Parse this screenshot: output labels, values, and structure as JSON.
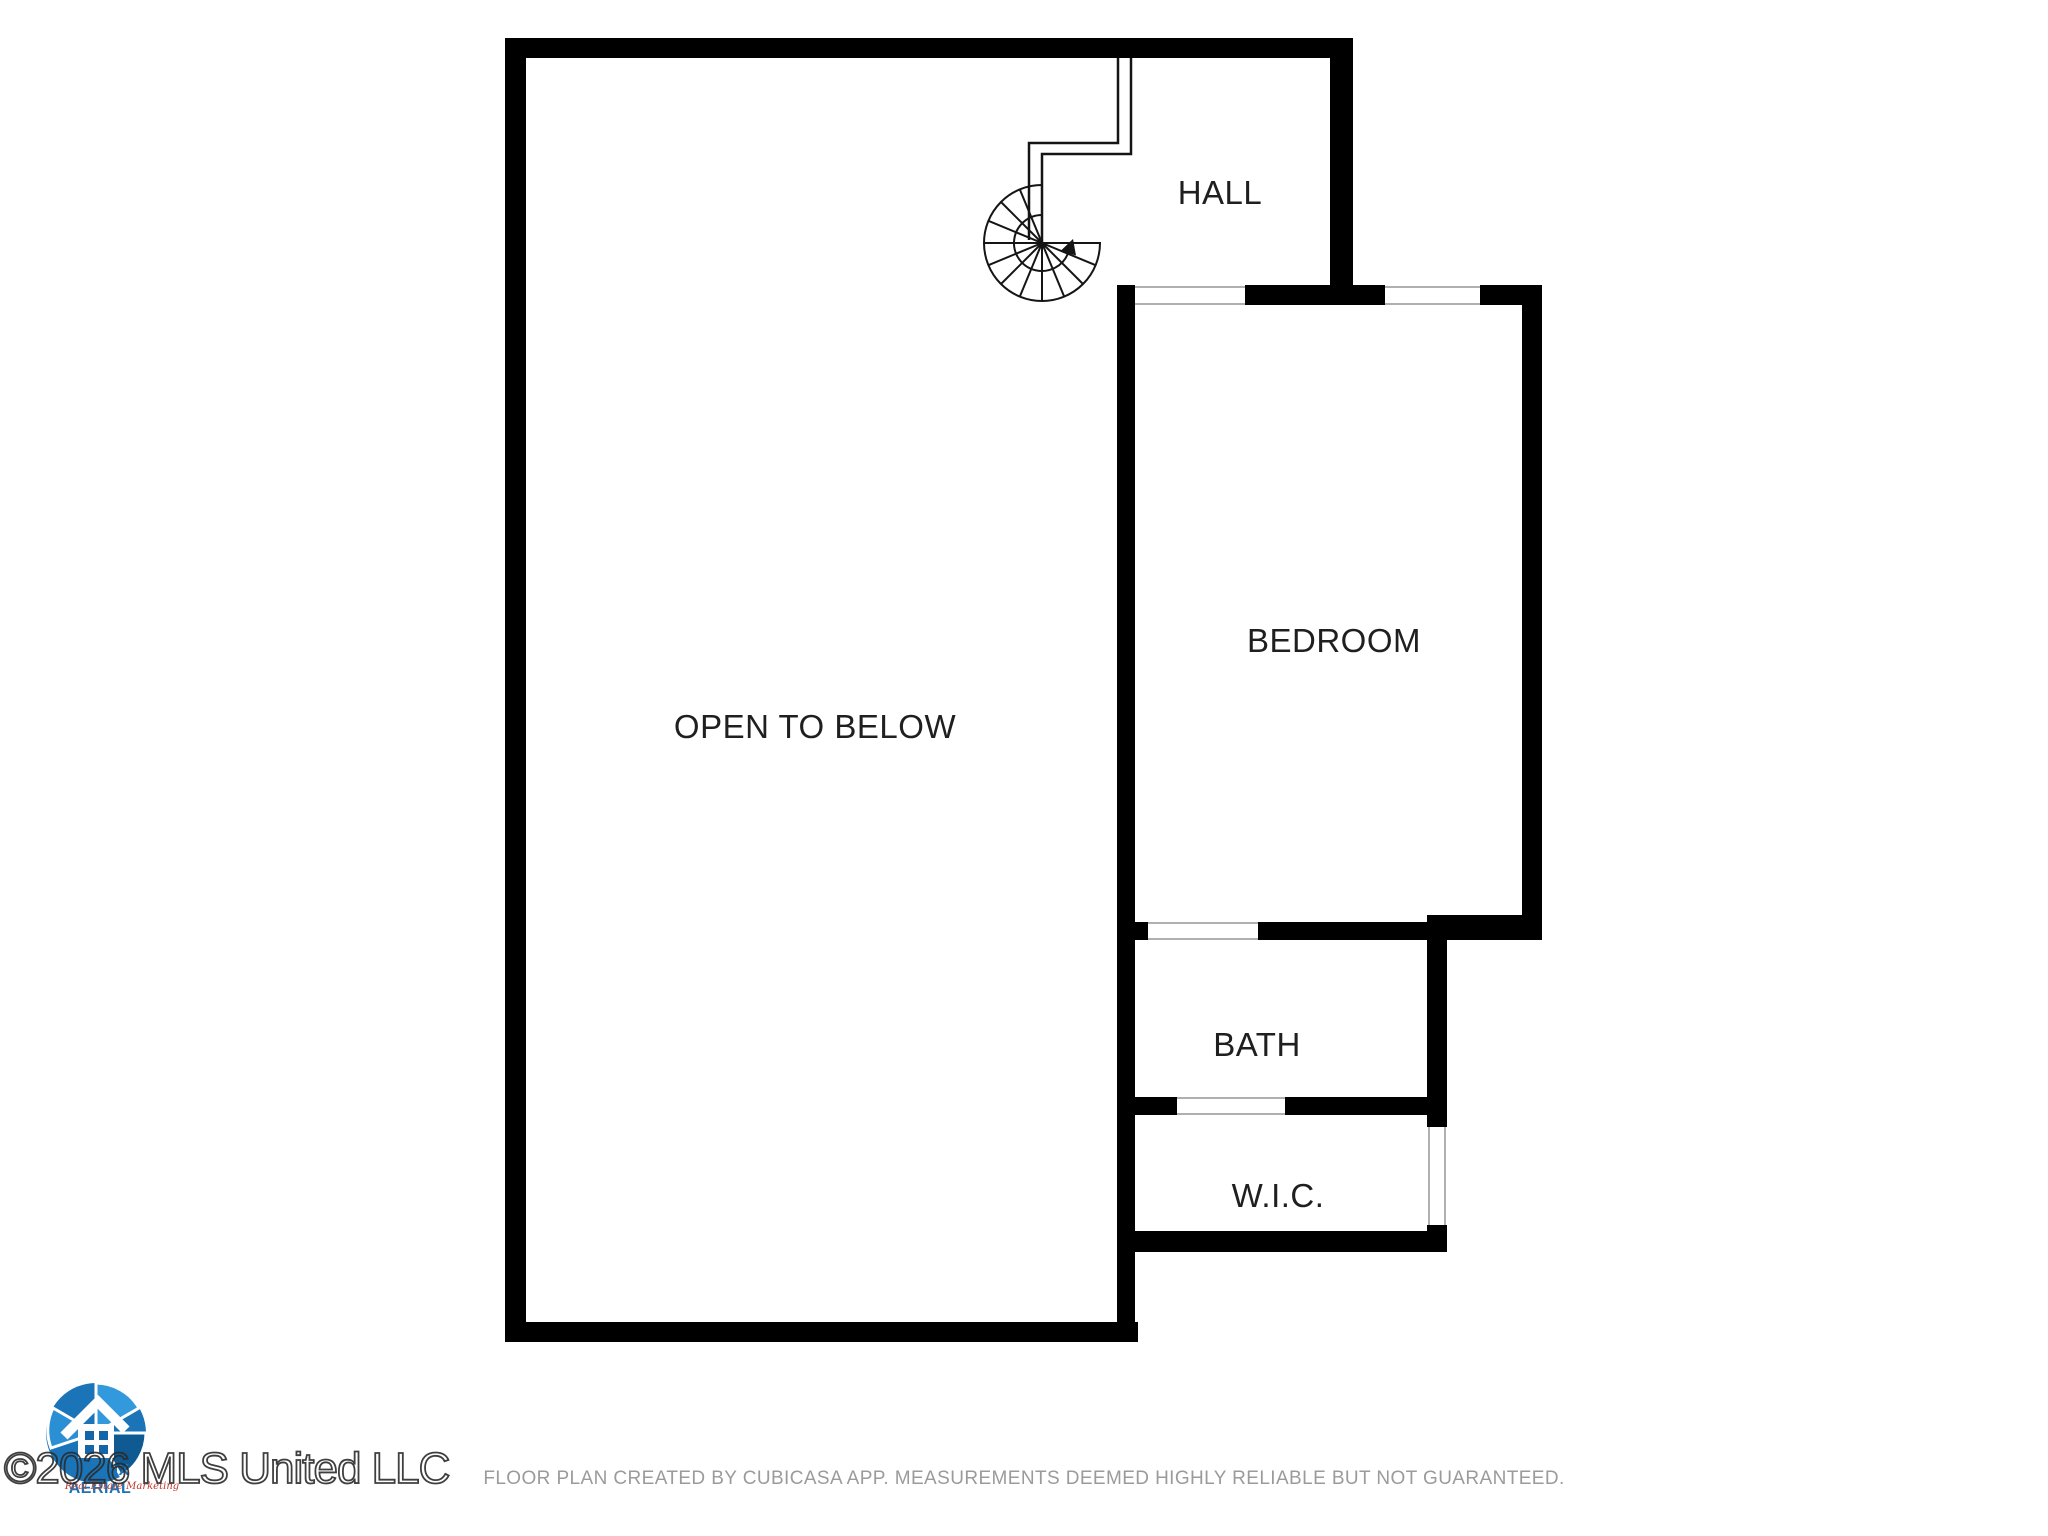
{
  "rooms": {
    "hall": {
      "label": "HALL"
    },
    "bedroom": {
      "label": "BEDROOM"
    },
    "open_to_below": {
      "label": "OPEN TO BELOW"
    },
    "bath": {
      "label": "BATH"
    },
    "wic": {
      "label": "W.I.C."
    }
  },
  "icons": {
    "staircase": "spiral-staircase-icon",
    "logo": "camera-shutter-house-logo"
  },
  "watermark": {
    "text": "©2026 MLS United LLC"
  },
  "logo": {
    "wordmark": "GEAUX AERIAL",
    "tagline": "Real Estate Marketing"
  },
  "footer": {
    "disclaimer": "FLOOR PLAN CREATED BY CUBICASA APP. MEASUREMENTS DEEMED HIGHLY RELIABLE BUT NOT GUARANTEED."
  },
  "colors": {
    "background": "#ffffff",
    "wall": "#000000",
    "opening_line": "#b0b0b0",
    "label_text": "#1f1f1f",
    "footer_text": "#9b9b9b",
    "watermark_outline": "#2b2b2b",
    "logo_blue": "#1b74b8",
    "logo_blue_light": "#3399dd",
    "logo_blue_dark": "#0f5a93",
    "logo_red": "#c0392b"
  }
}
